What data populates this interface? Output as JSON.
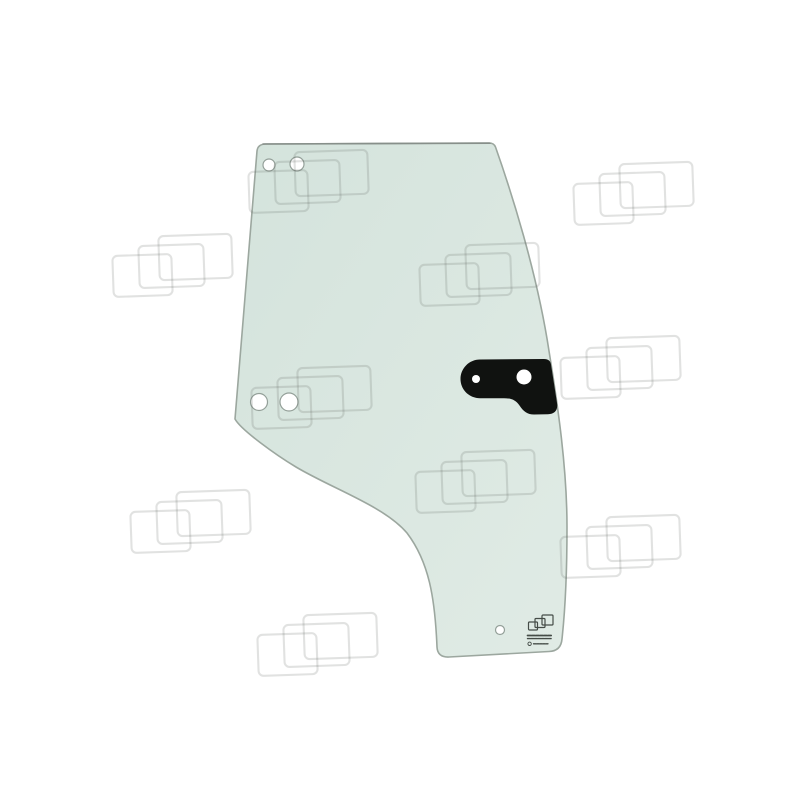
{
  "canvas": {
    "width": 800,
    "height": 800,
    "background": "#ffffff"
  },
  "photo": {
    "subject": "door-glass-panel",
    "glass": {
      "fill_dark": "#d4e3dc",
      "fill_light": "#e0ebe5",
      "edge_color": "#9ca79f",
      "top_edge_color": "#878f8a",
      "hole_ring_color": "#94a099",
      "hole_fill": "#ffffff",
      "mount_holes": [
        {
          "x": 269,
          "y": 165,
          "r": 6.0
        },
        {
          "x": 297,
          "y": 164,
          "r": 7.0
        },
        {
          "x": 259,
          "y": 402,
          "r": 8.5
        },
        {
          "x": 289,
          "y": 402,
          "r": 9.0
        },
        {
          "x": 500,
          "y": 630,
          "r": 4.5
        }
      ]
    },
    "bracket": {
      "color": "#101210",
      "hole_fill": "#ffffff",
      "holes": [
        {
          "x": 476,
          "y": 379,
          "r": 4.0
        },
        {
          "x": 524,
          "y": 377,
          "r": 7.5
        }
      ]
    },
    "stamp": {
      "color": "#454c47",
      "text_legible": false
    }
  },
  "watermark": {
    "stroke_color": "rgba(88,94,90,0.18)",
    "positions": [
      {
        "x": 248,
        "y": 150
      },
      {
        "x": 573,
        "y": 162
      },
      {
        "x": 112,
        "y": 234
      },
      {
        "x": 419,
        "y": 243
      },
      {
        "x": 560,
        "y": 336
      },
      {
        "x": 251,
        "y": 366
      },
      {
        "x": 415,
        "y": 450
      },
      {
        "x": 130,
        "y": 490
      },
      {
        "x": 560,
        "y": 515
      },
      {
        "x": 257,
        "y": 613
      }
    ]
  }
}
